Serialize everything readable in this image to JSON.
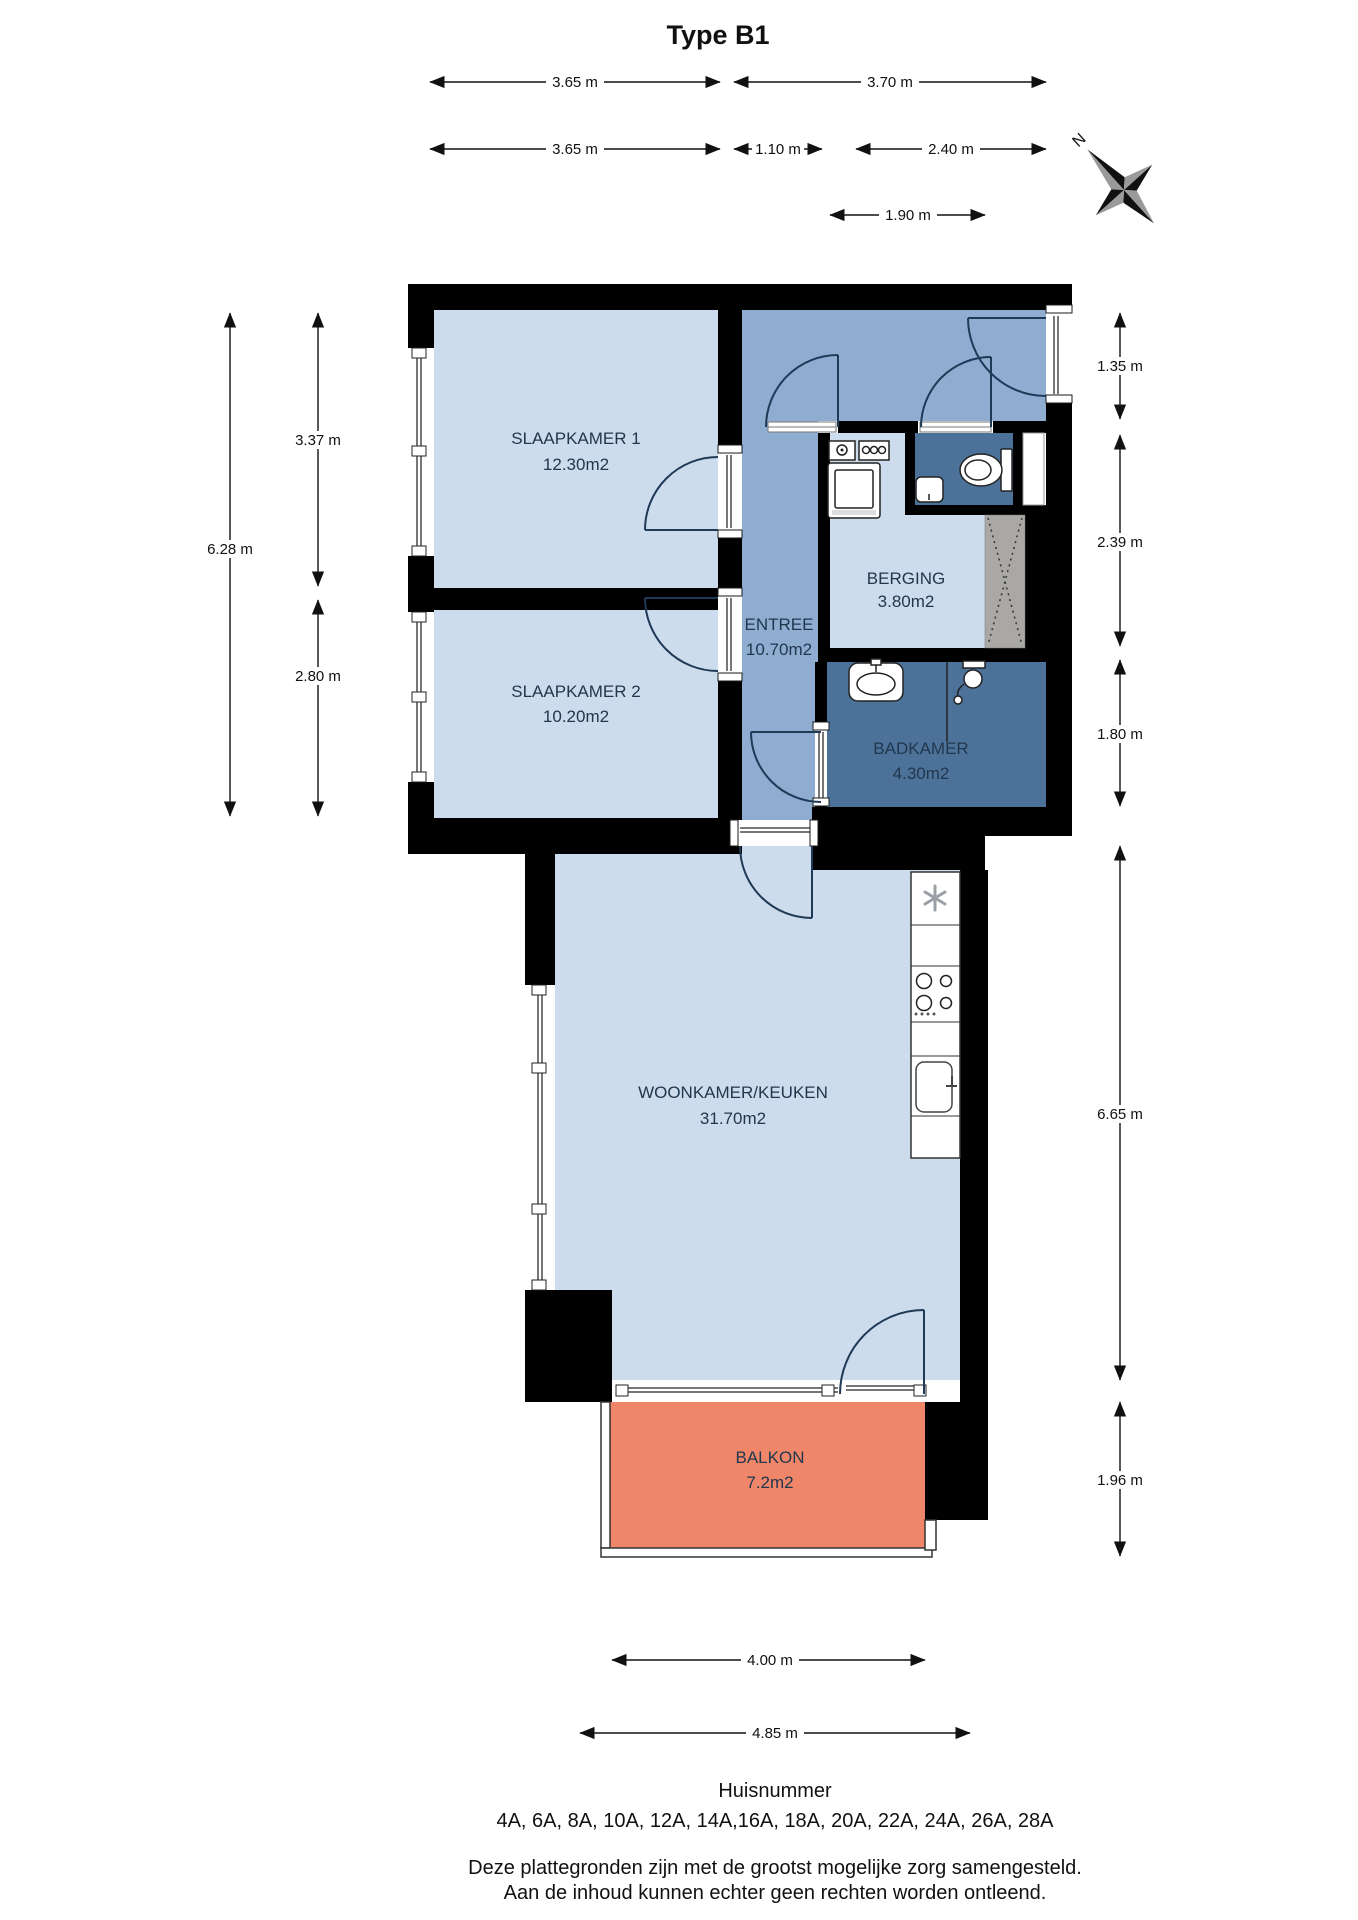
{
  "title": "Type B1",
  "compass": {
    "north": "N"
  },
  "rooms": [
    {
      "name": "SLAAPKAMER 1",
      "area": "12.30m2"
    },
    {
      "name": "SLAAPKAMER 2",
      "area": "10.20m2"
    },
    {
      "name": "ENTREE",
      "area": "10.70m2"
    },
    {
      "name": "BERGING",
      "area": "3.80m2"
    },
    {
      "name": "BADKAMER",
      "area": "4.30m2"
    },
    {
      "name": "WOONKAMER/KEUKEN",
      "area": "31.70m2"
    },
    {
      "name": "BALKON",
      "area": "7.2m2"
    }
  ],
  "dims": [
    {
      "label": "3.65 m"
    },
    {
      "label": "3.70 m"
    },
    {
      "label": "3.65 m"
    },
    {
      "label": "1.10 m"
    },
    {
      "label": "2.40 m"
    },
    {
      "label": "1.90 m"
    },
    {
      "label": "4.00 m"
    },
    {
      "label": "4.85 m"
    },
    {
      "label": "6.28 m"
    },
    {
      "label": "3.37 m"
    },
    {
      "label": "2.80 m"
    },
    {
      "label": "1.35 m"
    },
    {
      "label": "2.39 m"
    },
    {
      "label": "1.80 m"
    },
    {
      "label": "6.65 m"
    },
    {
      "label": "1.96 m"
    }
  ],
  "footer": {
    "huisnummer_label": "Huisnummer",
    "huisnummers": "4A, 6A, 8A, 10A, 12A, 14A,16A, 18A, 20A, 22A, 24A, 26A, 28A",
    "disclaimer_line1": "Deze plattegronden zijn met de grootst mogelijke zorg samengesteld.",
    "disclaimer_line2": "Aan de inhoud kunnen echter geen rechten worden ontleend."
  },
  "fixtures": [
    "toilet",
    "hand-basin",
    "washbasin",
    "shower",
    "washing-machine",
    "utility-meters",
    "fridge-freezer-snowflake",
    "cooktop",
    "kitchen-sink",
    "duct-shaft"
  ],
  "colors": {
    "wall": "#000000",
    "room_light": "#cddcec",
    "entree": "#8fadd0",
    "wet_dark": "#4d7299",
    "balcony": "#ef8669",
    "shaft": "#a9a8a4",
    "label_text": "#21374e"
  }
}
